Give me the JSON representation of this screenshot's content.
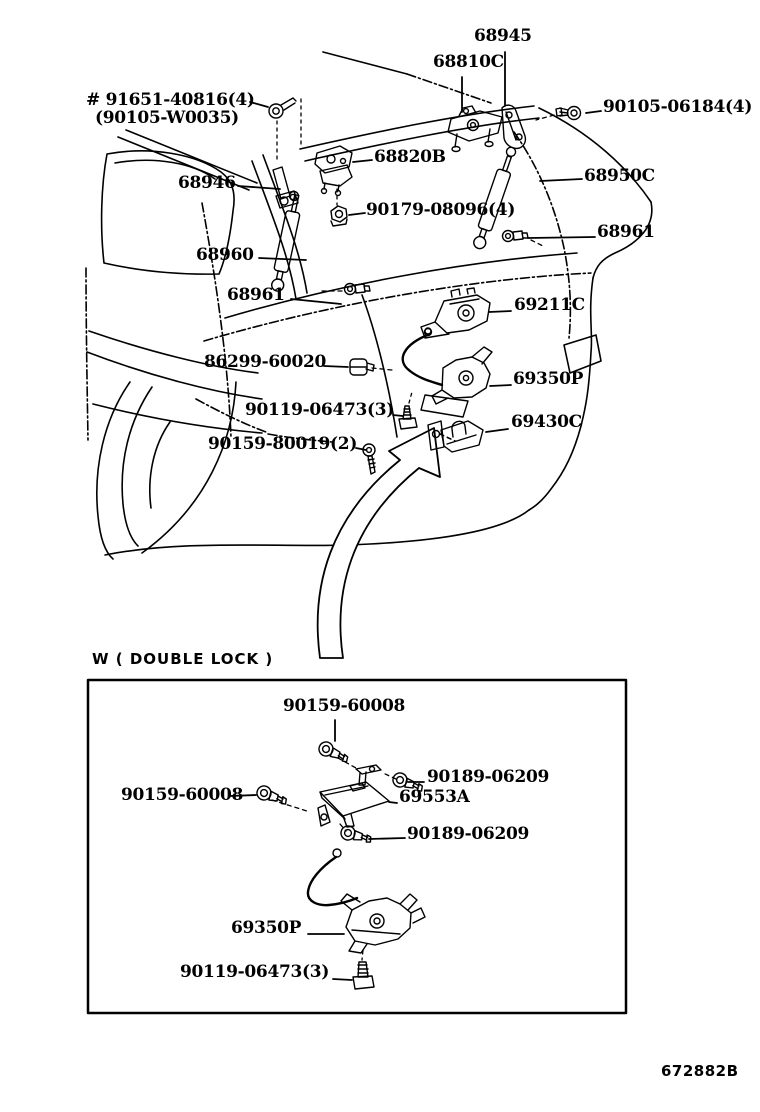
{
  "colors": {
    "background": "#ffffff",
    "ink": "#000000"
  },
  "main_diagram": {
    "labels": [
      {
        "id": "68945",
        "text": "68945"
      },
      {
        "id": "68810C",
        "text": "68810C"
      },
      {
        "id": "91651-40816",
        "text": "# 91651-40816(4)"
      },
      {
        "id": "90105-W0035",
        "text": "(90105-W0035)"
      },
      {
        "id": "90105-06184",
        "text": "90105-06184(4)"
      },
      {
        "id": "68820B",
        "text": "68820B"
      },
      {
        "id": "68950C",
        "text": "68950C"
      },
      {
        "id": "68946",
        "text": "68946"
      },
      {
        "id": "90179-08096",
        "text": "90179-08096(4)"
      },
      {
        "id": "68961-right",
        "text": "68961"
      },
      {
        "id": "68960",
        "text": "68960"
      },
      {
        "id": "68961-left",
        "text": "68961"
      },
      {
        "id": "69211C",
        "text": "69211C"
      },
      {
        "id": "86299-60020",
        "text": "86299-60020"
      },
      {
        "id": "69350P",
        "text": "69350P"
      },
      {
        "id": "90119-06473",
        "text": "90119-06473(3)"
      },
      {
        "id": "69430C",
        "text": "69430C"
      },
      {
        "id": "90159-80019",
        "text": "90159-80019(2)"
      }
    ]
  },
  "inset": {
    "title": "W ( DOUBLE  LOCK )",
    "labels": [
      {
        "id": "90159-60008-top",
        "text": "90159-60008"
      },
      {
        "id": "90189-06209-upper",
        "text": "90189-06209"
      },
      {
        "id": "90159-60008-left",
        "text": "90159-60008"
      },
      {
        "id": "69553A",
        "text": "69553A"
      },
      {
        "id": "90189-06209-lower",
        "text": "90189-06209"
      },
      {
        "id": "69350P",
        "text": "69350P"
      },
      {
        "id": "90119-06473",
        "text": "90119-06473(3)"
      }
    ]
  },
  "footer": {
    "code": "672882B"
  }
}
